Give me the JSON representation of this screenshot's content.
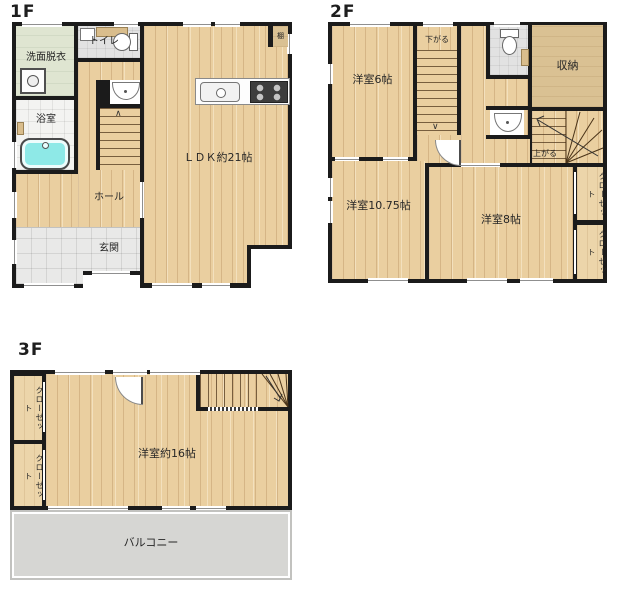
{
  "floors": {
    "f1": {
      "label": "1F",
      "rooms": {
        "senmen": "洗面脱衣",
        "toilet": "トイレ",
        "bath": "浴室",
        "hall": "ホール",
        "genkan": "玄関",
        "ldk": "ＬＤＫ約21帖",
        "shelf": "棚"
      }
    },
    "f2": {
      "label": "2F",
      "rooms": {
        "room6": "洋室6帖",
        "storage": "収納",
        "room1075": "洋室10.75帖",
        "room8": "洋室8帖",
        "closet1": "クローゼット",
        "closet2": "クローゼット"
      },
      "stairs": {
        "down": "下がる",
        "up": "上がる"
      }
    },
    "f3": {
      "label": "3F",
      "rooms": {
        "room16": "洋室約16帖",
        "balcony": "バルコニー",
        "closet1": "クローゼット",
        "closet2": "クローゼット"
      }
    }
  },
  "colors": {
    "wall": "#1b1b1b",
    "wood_floor": "#eacfa0",
    "storage_tan": "#dac193",
    "washroom_green": "#dfe5d1",
    "tile_gray": "#e2e2e2",
    "bathtub_cyan": "#8ee9e7",
    "balcony_gray": "#d6d6d3"
  }
}
